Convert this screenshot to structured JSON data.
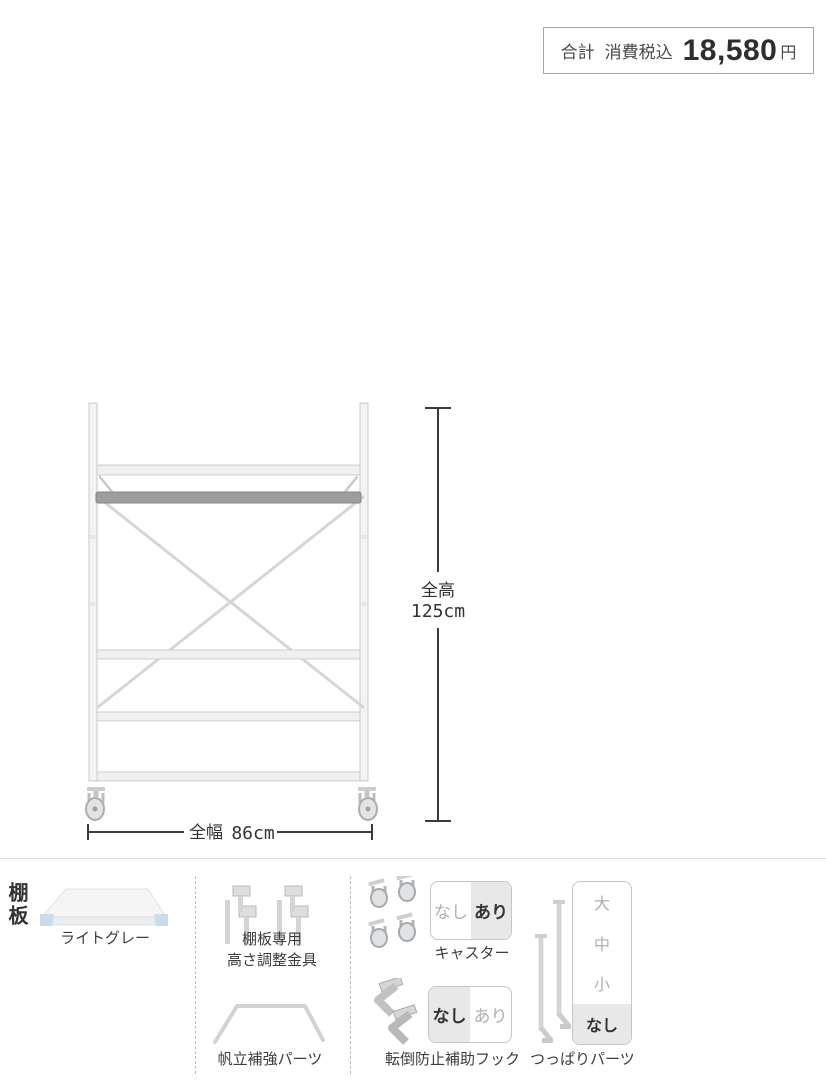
{
  "price_box": {
    "total_label": "合計",
    "tax_label": "消費税込",
    "amount": "18,580",
    "currency": "円"
  },
  "diagram": {
    "height_dim": {
      "label": "全高",
      "value": "125cm"
    },
    "width_dim": {
      "label": "全幅",
      "value": "86cm"
    }
  },
  "options_panel": {
    "row_label": "棚板",
    "shelf_color": {
      "label": "ライトグレー"
    },
    "height_adjuster": {
      "label_line1": "棚板専用",
      "label_line2": "高さ調整金具"
    },
    "reinforcement": {
      "label": "帆立補強パーツ"
    },
    "casters": {
      "label": "キャスター",
      "options": [
        {
          "label": "なし",
          "selected": false
        },
        {
          "label": "あり",
          "selected": true
        }
      ]
    },
    "anti_tip_hook": {
      "label": "転倒防止補助フック",
      "options": [
        {
          "label": "なし",
          "selected": true
        },
        {
          "label": "あり",
          "selected": false
        }
      ]
    },
    "tension_parts": {
      "label": "つっぱりパーツ",
      "options": [
        {
          "label": "大",
          "selected": false
        },
        {
          "label": "中",
          "selected": false
        },
        {
          "label": "小",
          "selected": false
        },
        {
          "label": "なし",
          "selected": true
        }
      ]
    }
  },
  "colors": {
    "selected_option_bg": "#e8e8e8",
    "option_border": "#c6c6c6",
    "unselected_option_text": "#b0b0b0",
    "selected_option_text": "#333333",
    "dimension_line": "#3a3a3a",
    "panel_divider": "#bdbdbd",
    "rack_light_gray": "#d6d6d6",
    "rack_dark_bar": "#9d9d9d",
    "shelf_corner_accent": "#c9dcea"
  }
}
